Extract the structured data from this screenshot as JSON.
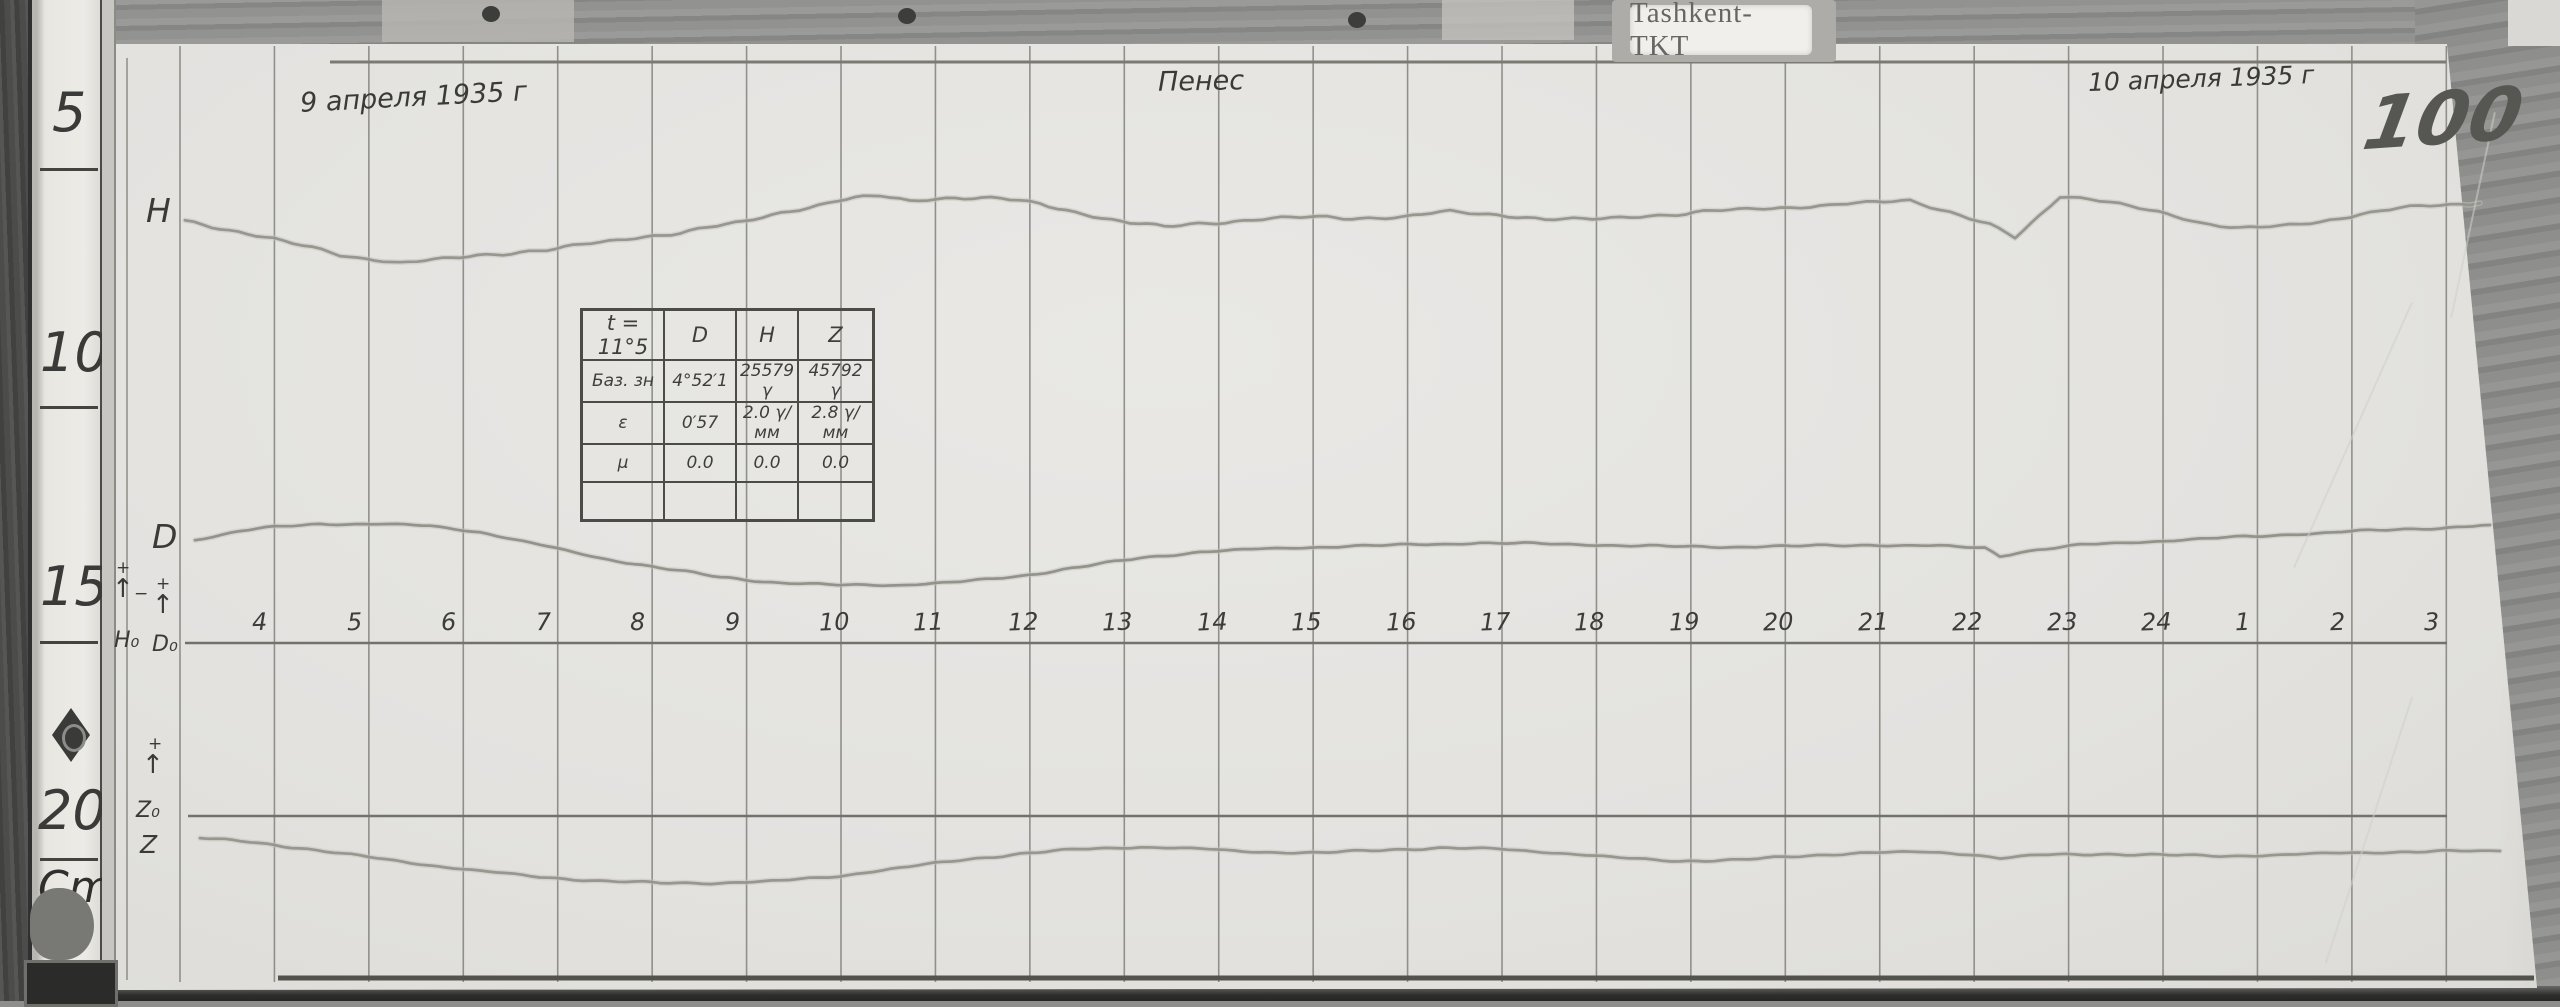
{
  "scene": {
    "station_label": "Tashkent-TKT",
    "sheet_number": "100",
    "date_left": "9 апреля 1935 г",
    "date_right": "10 апреля 1935 г",
    "center_note": "Пенес",
    "ruler": {
      "ticks": [
        "5",
        "10",
        "15",
        "20"
      ],
      "unit": "Cm"
    },
    "margin_labels": {
      "h_trace": "H",
      "d_trace": "D",
      "h0": "H₀",
      "d0": "D₀",
      "z0": "Z₀",
      "z_trace": "Z",
      "plus": "+",
      "minus": "−",
      "arrow_up": "↑"
    }
  },
  "cal_table": {
    "headers": [
      "t = 11°5",
      "D",
      "H",
      "Z"
    ],
    "rows": [
      [
        "Баз. зн",
        "4°52′1",
        "25579 γ",
        "45792 γ"
      ],
      [
        "ε",
        "0′57",
        "2.0 γ/мм",
        "2.8 γ/мм"
      ],
      [
        "μ",
        "0.0",
        "0.0",
        "0.0"
      ],
      [
        "",
        "",
        "",
        ""
      ]
    ]
  },
  "chart_data": {
    "type": "line",
    "title": "Magnetogram (H, D, Z variations) — Tashkent-TKT, 9–10 April 1935, sheet 100",
    "xlabel": "Hours, local time (4…24, 1…3)",
    "ylabel": "Trace deflection on photographic paper (image px, down = positive)",
    "x_categories": [
      "4",
      "5",
      "6",
      "7",
      "8",
      "9",
      "10",
      "11",
      "12",
      "13",
      "14",
      "15",
      "16",
      "17",
      "18",
      "19",
      "20",
      "21",
      "22",
      "23",
      "24",
      "1",
      "2",
      "3"
    ],
    "hour_axis": {
      "first_hour_x_px": 274.4,
      "step_px": 94.43,
      "label_y_px": 610,
      "baseline_y_px": 643
    },
    "grid": {
      "first_line_x_px": 180,
      "line_count": 25,
      "step_px": 94.43,
      "top_px": 46,
      "bottom_px": 982,
      "color": "#82827c"
    },
    "baselines": [
      {
        "name": "H0-D0 baseline",
        "y_px": 643,
        "x1_px": 185,
        "x2_px": 2447,
        "color": "#72726c"
      },
      {
        "name": "Z0 baseline",
        "y_px": 816,
        "x1_px": 188,
        "x2_px": 2447,
        "color": "#72726c"
      }
    ],
    "frame_lines": [
      {
        "name": "top-margin-line",
        "x1": 330,
        "y1": 62,
        "x2": 2446,
        "y2": 62,
        "w": 3,
        "color": "#7b7b73"
      },
      {
        "name": "bottom-edge-line",
        "x1": 278,
        "y1": 978,
        "x2": 2534,
        "y2": 978,
        "w": 5,
        "color": "#53534d"
      },
      {
        "name": "left-paper-edge-line",
        "x1": 127,
        "y1": 58,
        "x2": 127,
        "y2": 980,
        "w": 1.5,
        "color": "#8e8e88"
      }
    ],
    "legend_position": "handwritten letters in left margin",
    "series": [
      {
        "name": "H",
        "color": "#94948c",
        "jitter": 1.0,
        "points": [
          [
            185,
            222
          ],
          [
            274,
            238
          ],
          [
            340,
            256
          ],
          [
            400,
            262
          ],
          [
            460,
            258
          ],
          [
            520,
            252
          ],
          [
            600,
            243
          ],
          [
            680,
            232
          ],
          [
            744,
            222
          ],
          [
            790,
            211
          ],
          [
            838,
            200
          ],
          [
            880,
            196
          ],
          [
            910,
            201
          ],
          [
            955,
            197
          ],
          [
            1000,
            199
          ],
          [
            1040,
            204
          ],
          [
            1075,
            212
          ],
          [
            1130,
            223
          ],
          [
            1164,
            227
          ],
          [
            1216,
            222
          ],
          [
            1253,
            220
          ],
          [
            1310,
            217
          ],
          [
            1360,
            218
          ],
          [
            1403,
            217
          ],
          [
            1450,
            212
          ],
          [
            1498,
            214
          ],
          [
            1545,
            220
          ],
          [
            1592,
            219
          ],
          [
            1640,
            216
          ],
          [
            1686,
            214
          ],
          [
            1730,
            210
          ],
          [
            1781,
            207
          ],
          [
            1830,
            206
          ],
          [
            1875,
            202
          ],
          [
            1910,
            200
          ],
          [
            1950,
            212
          ],
          [
            1990,
            225
          ],
          [
            2015,
            238
          ],
          [
            2040,
            215
          ],
          [
            2060,
            196
          ],
          [
            2090,
            199
          ],
          [
            2120,
            205
          ],
          [
            2158,
            212
          ],
          [
            2200,
            222
          ],
          [
            2240,
            228
          ],
          [
            2280,
            227
          ],
          [
            2320,
            222
          ],
          [
            2360,
            214
          ],
          [
            2400,
            208
          ],
          [
            2440,
            205
          ],
          [
            2480,
            203
          ]
        ]
      },
      {
        "name": "D",
        "color": "#8f8f87",
        "jitter": 0.55,
        "points": [
          [
            195,
            540
          ],
          [
            240,
            531
          ],
          [
            274,
            527
          ],
          [
            320,
            524
          ],
          [
            380,
            524
          ],
          [
            430,
            526
          ],
          [
            480,
            532
          ],
          [
            540,
            545
          ],
          [
            600,
            558
          ],
          [
            660,
            568
          ],
          [
            720,
            577
          ],
          [
            780,
            583
          ],
          [
            838,
            585
          ],
          [
            900,
            585
          ],
          [
            960,
            582
          ],
          [
            1020,
            576
          ],
          [
            1080,
            567
          ],
          [
            1140,
            558
          ],
          [
            1200,
            552
          ],
          [
            1260,
            549
          ],
          [
            1320,
            547
          ],
          [
            1400,
            545
          ],
          [
            1480,
            543
          ],
          [
            1560,
            544
          ],
          [
            1640,
            546
          ],
          [
            1720,
            547
          ],
          [
            1800,
            546
          ],
          [
            1870,
            545
          ],
          [
            1940,
            546
          ],
          [
            1985,
            548
          ],
          [
            2000,
            556
          ],
          [
            2020,
            552
          ],
          [
            2080,
            545
          ],
          [
            2140,
            542
          ],
          [
            2200,
            539
          ],
          [
            2280,
            535
          ],
          [
            2360,
            531
          ],
          [
            2440,
            528
          ],
          [
            2490,
            525
          ]
        ]
      },
      {
        "name": "Z",
        "color": "#94948c",
        "jitter": 0.55,
        "points": [
          [
            200,
            838
          ],
          [
            250,
            842
          ],
          [
            300,
            848
          ],
          [
            360,
            856
          ],
          [
            420,
            864
          ],
          [
            480,
            871
          ],
          [
            540,
            877
          ],
          [
            600,
            881
          ],
          [
            660,
            883
          ],
          [
            720,
            883
          ],
          [
            780,
            881
          ],
          [
            838,
            876
          ],
          [
            900,
            868
          ],
          [
            960,
            860
          ],
          [
            1020,
            854
          ],
          [
            1080,
            849
          ],
          [
            1140,
            847
          ],
          [
            1200,
            849
          ],
          [
            1260,
            852
          ],
          [
            1320,
            853
          ],
          [
            1380,
            850
          ],
          [
            1440,
            848
          ],
          [
            1500,
            849
          ],
          [
            1560,
            853
          ],
          [
            1620,
            858
          ],
          [
            1680,
            861
          ],
          [
            1740,
            860
          ],
          [
            1800,
            856
          ],
          [
            1860,
            853
          ],
          [
            1920,
            852
          ],
          [
            1969,
            854
          ],
          [
            2000,
            858
          ],
          [
            2040,
            855
          ],
          [
            2100,
            854
          ],
          [
            2160,
            855
          ],
          [
            2220,
            856
          ],
          [
            2280,
            855
          ],
          [
            2340,
            853
          ],
          [
            2400,
            852
          ],
          [
            2460,
            851
          ],
          [
            2500,
            851
          ]
        ]
      }
    ]
  }
}
